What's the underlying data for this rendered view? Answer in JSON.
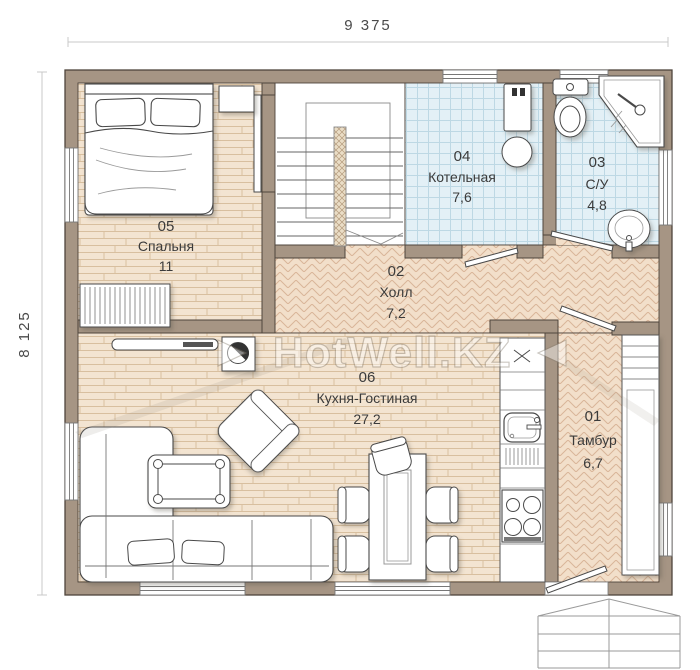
{
  "plan": {
    "width_label": "9 375",
    "height_label": "8 125",
    "watermark": "HotWell.KZ",
    "rooms": [
      {
        "number": "05",
        "name": "Спальня",
        "area": "11"
      },
      {
        "number": "04",
        "name": "Котельная",
        "area": "7,6"
      },
      {
        "number": "03",
        "name": "С/У",
        "area": "4,8"
      },
      {
        "number": "02",
        "name": "Холл",
        "area": "7,2"
      },
      {
        "number": "06",
        "name": "Кухня-Гостиная",
        "area": "27,2"
      },
      {
        "number": "01",
        "name": "Тамбур",
        "area": "6,7"
      }
    ],
    "colors": {
      "wall": "#a69584",
      "wood_floor": "#f3e4d1",
      "herringbone_floor": "#f2dfca",
      "tile_floor": "#e3f0f6"
    }
  }
}
